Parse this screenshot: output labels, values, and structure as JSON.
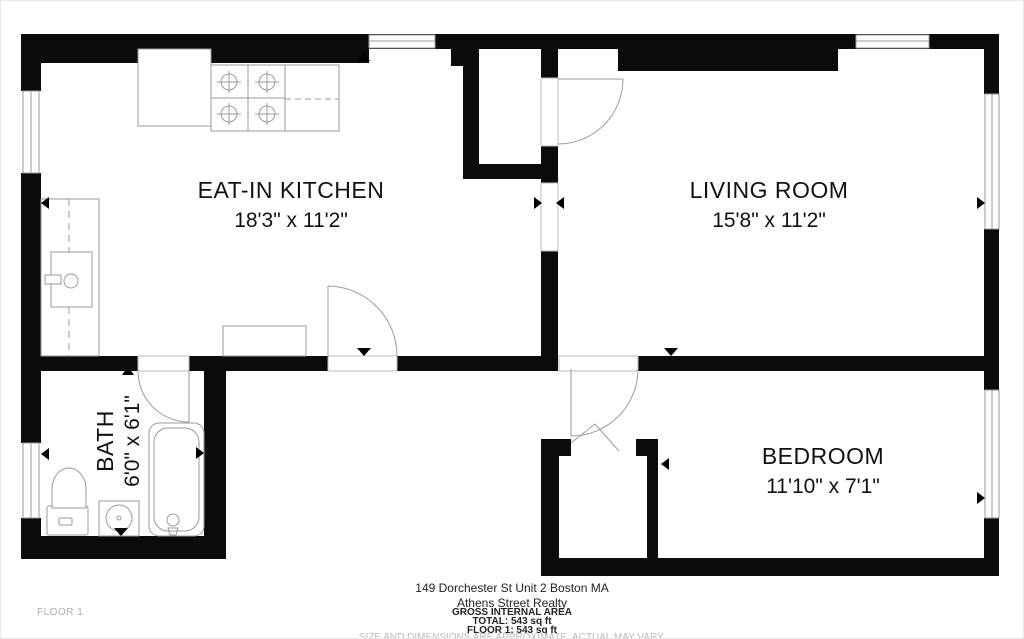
{
  "floorplan": {
    "rooms": [
      {
        "name": "EAT-IN KITCHEN",
        "dims": "18'3\" x 11'2\""
      },
      {
        "name": "LIVING ROOM",
        "dims": "15'8\" x 11'2\""
      },
      {
        "name": "BEDROOM",
        "dims": "11'10\" x 7'1\""
      },
      {
        "name": "BATH",
        "dims": "6'0\" x 6'1\""
      }
    ],
    "floor_label": "FLOOR 1"
  },
  "footer": {
    "address": "149 Dorchester St Unit 2 Boston MA",
    "agency": "Athens Street Realty",
    "area_heading": "GROSS INTERNAL AREA",
    "total": "TOTAL: 543 sq ft",
    "floor_total": "FLOOR 1: 543 sq ft",
    "disclaimer": "SIZE AND DIMENSIONS ARE APPROXIMATE, ACTUAL MAY VARY."
  },
  "colors": {
    "wall": "#0b0b0b",
    "line": "#9a9a9a",
    "text": "#111111",
    "muted": "#b9b9b9"
  }
}
